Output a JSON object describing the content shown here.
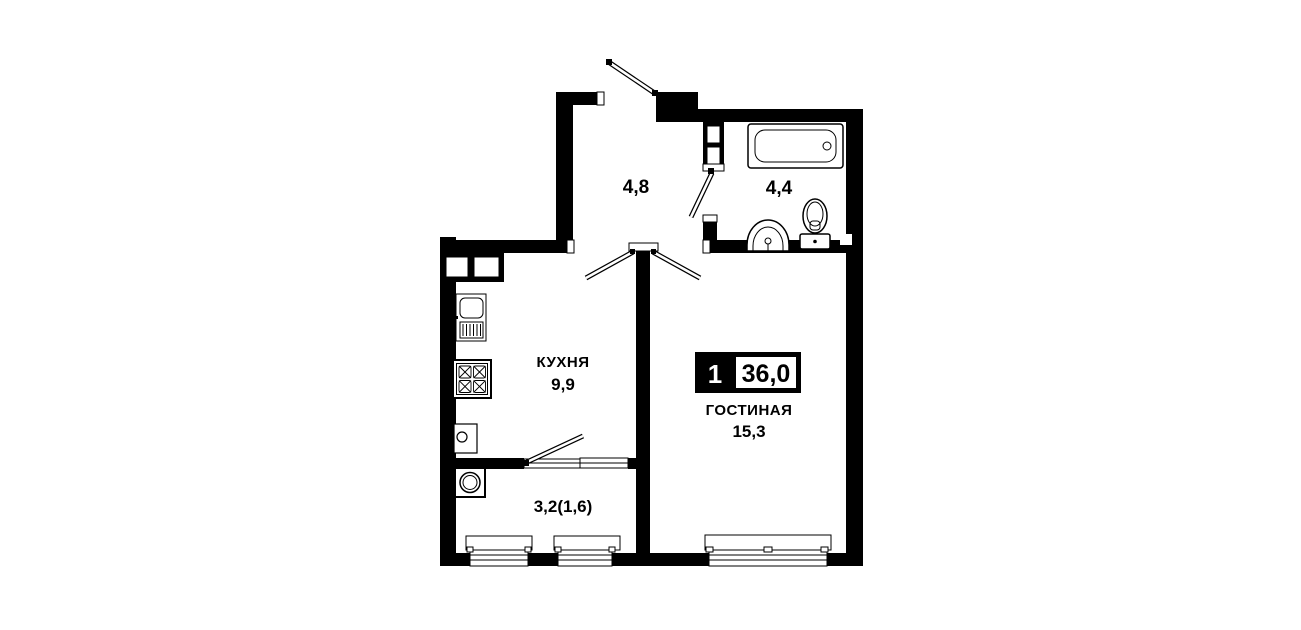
{
  "floorplan": {
    "type": "apartment-floor-plan",
    "badge": {
      "rooms_count": "1",
      "total_area": "36,0"
    },
    "rooms": {
      "hallway": {
        "area": "4,8"
      },
      "bathroom": {
        "area": "4,4"
      },
      "kitchen": {
        "name": "КУХНЯ",
        "area": "9,9"
      },
      "living_room": {
        "name": "ГОСТИНАЯ",
        "area": "15,3"
      },
      "balcony": {
        "area": "3,2(1,6)"
      }
    },
    "fixtures": [
      "bathtub",
      "pedestal-sink",
      "toilet",
      "kitchen-sink",
      "stove",
      "cabinet",
      "washing-machine",
      "vent-duct"
    ],
    "colors": {
      "wall": "#000000",
      "background": "#ffffff",
      "badge_bg": "#000000",
      "badge_text": "#ffffff"
    }
  }
}
